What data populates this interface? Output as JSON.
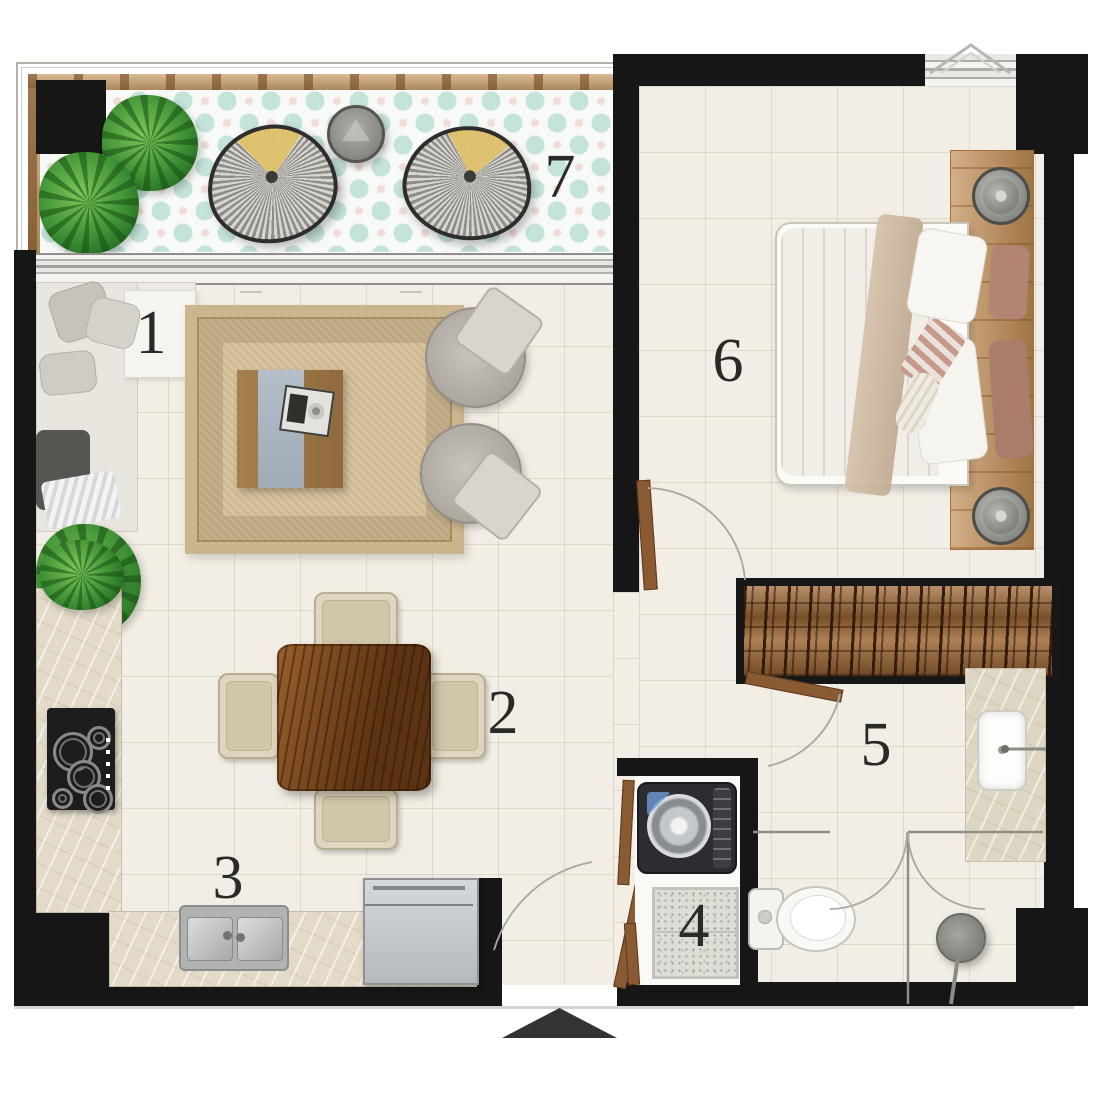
{
  "plan_type": "apartment-floor-plan",
  "rooms": {
    "living": {
      "label": "1"
    },
    "dining": {
      "label": "2"
    },
    "kitchen": {
      "label": "3"
    },
    "laundry": {
      "label": "4"
    },
    "bathroom": {
      "label": "5"
    },
    "bedroom": {
      "label": "6"
    },
    "balcony": {
      "label": "7"
    }
  },
  "markers": {
    "entrance_direction": "up"
  },
  "colors": {
    "wall": "#161616",
    "floor": "#f2eee5",
    "balcony_tile_mint": "#c4e3da",
    "egg_chair_cushion_yellow": "#e0c36c",
    "dining_table_wood": "#7a4a1f",
    "deck_wood": "#c9a06a",
    "rug": "#d8c49e"
  }
}
